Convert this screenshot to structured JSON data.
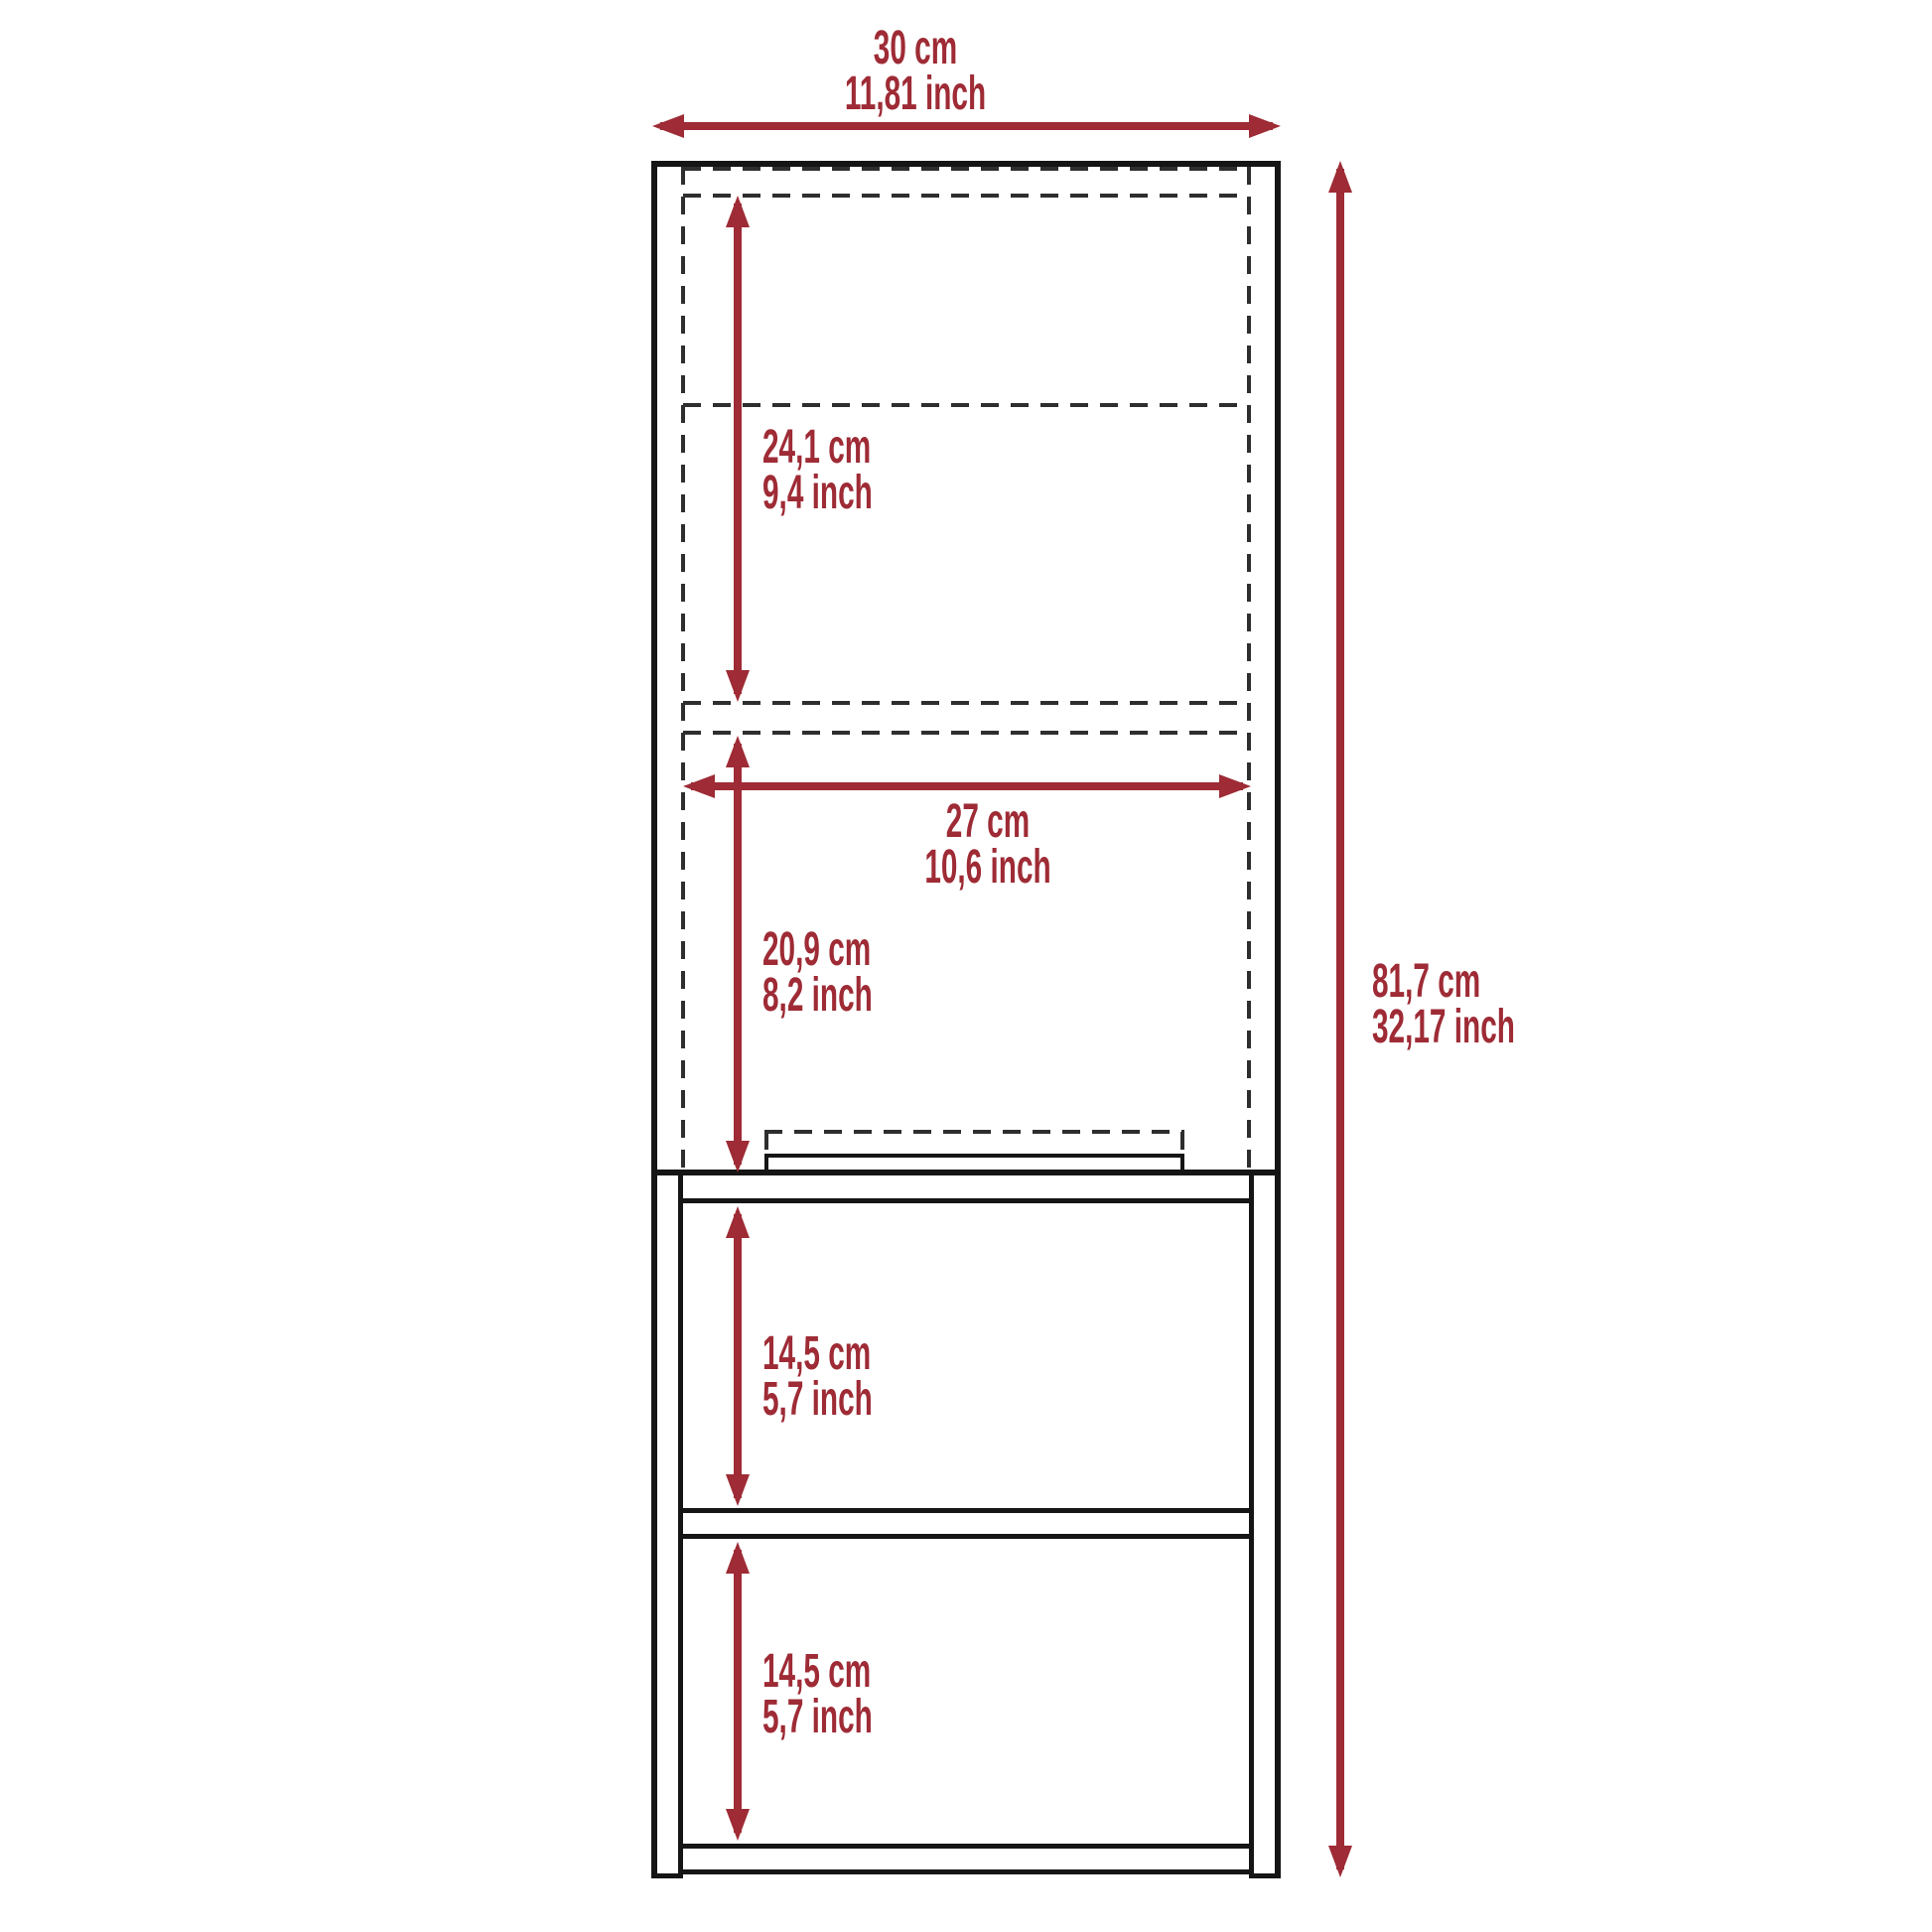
{
  "diagram_title": "cabinet-dimension-diagram",
  "colors": {
    "accent_red": "#9E2B35",
    "line_black": "#151515",
    "dash_gray": "#2e2e2e",
    "background": "#ffffff"
  },
  "labels": {
    "overall_width": {
      "cm": "30 cm",
      "inch": "11,81 inch"
    },
    "overall_height": {
      "cm": "81,7 cm",
      "inch": "32,17 inch"
    },
    "upper_interior": {
      "cm": "24,1 cm",
      "inch": "9,4 inch"
    },
    "door_width": {
      "cm": "27 cm",
      "inch": "10,6 inch"
    },
    "lower_interior": {
      "cm": "20,9 cm",
      "inch": "8,2 inch"
    },
    "shelf_top": {
      "cm": "14,5 cm",
      "inch": "5,7 inch"
    },
    "shelf_bottom": {
      "cm": "14,5 cm",
      "inch": "5,7 inch"
    }
  }
}
